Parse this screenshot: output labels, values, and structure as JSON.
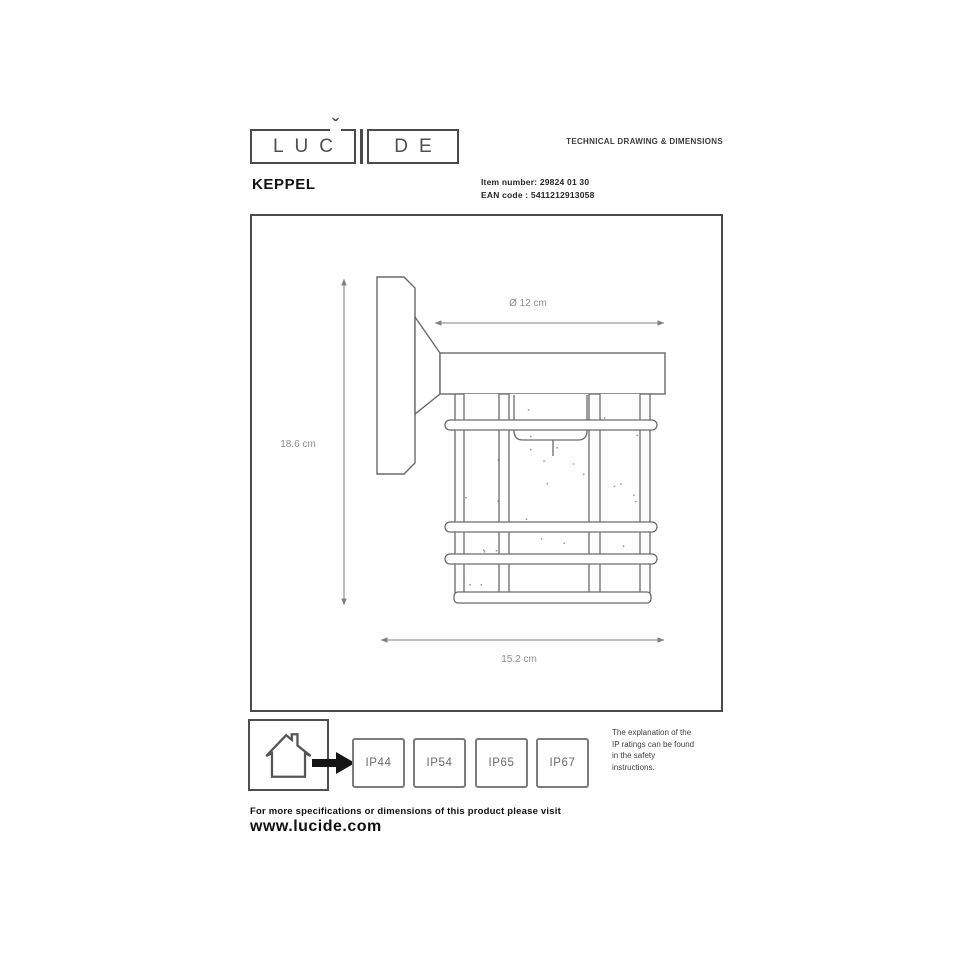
{
  "logo": {
    "left": "LUC",
    "caron": "ˇ",
    "right": "DE"
  },
  "header": {
    "title": "TECHNICAL DRAWING & DIMENSIONS"
  },
  "product": {
    "name": "KEPPEL",
    "item_number_label": "Item number:",
    "item_number_value": "29824 01 30",
    "ean_label": "EAN code :",
    "ean_value": "5411212913058"
  },
  "drawing": {
    "diameter_label": "Ø 12 cm",
    "height_label": "18.6 cm",
    "depth_label": "15.2 cm"
  },
  "ip_section": {
    "ratings": [
      "IP44",
      "IP54",
      "IP65",
      "IP67"
    ],
    "note_lines": [
      "The explanation of the",
      "IP ratings can be found",
      "in the safety",
      "instructions."
    ]
  },
  "footer": {
    "text": "For more specifications or dimensions of this product please visit",
    "url": "www.lucide.com"
  }
}
